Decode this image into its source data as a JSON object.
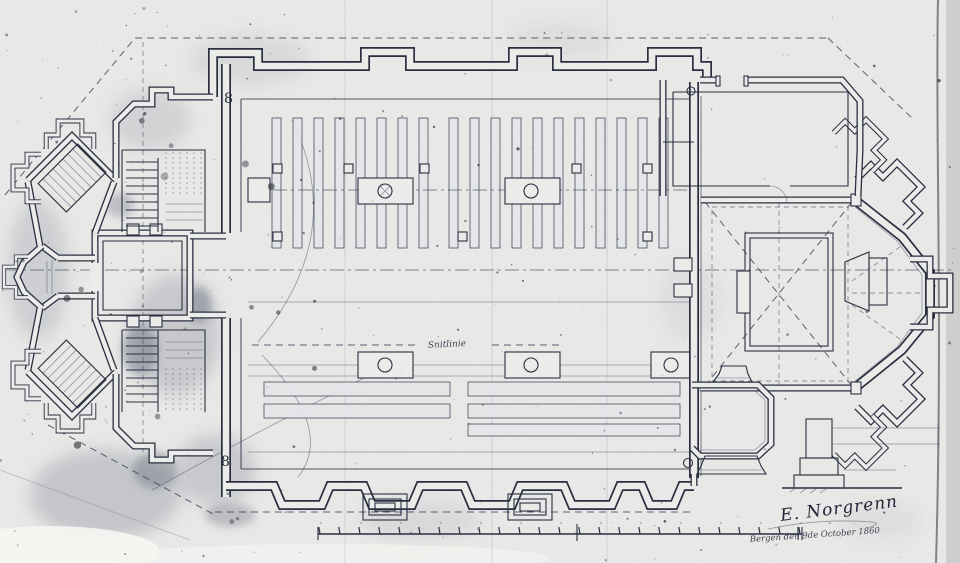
{
  "meta": {
    "title": "Scanned architectural ground plan of a church",
    "media": "photocopied ink drawing"
  },
  "colors": {
    "paper": "#ebebe9",
    "ink": "#2a2f40",
    "ink_faint": "#4a5068",
    "stain": "#7d8292"
  },
  "annotations": {
    "signature": "E. Norgrenn",
    "date_line": "Bergen den 9de October 1860",
    "center_line_label": "Snitlinie",
    "room_number_top": "8",
    "room_number_bottom": "8"
  },
  "scale_bar": {
    "tick_count": 25
  },
  "plan": {
    "parts": [
      "west-porch",
      "northwest-chapel",
      "southwest-chapel",
      "tower-hall",
      "north-staircase",
      "south-staircase",
      "nave",
      "pew-rows",
      "bench-rows",
      "chancel",
      "altar-platform",
      "altar",
      "apse",
      "apse-buttresses",
      "north-sacristy",
      "south-sacristy",
      "buttress-elevation-detail",
      "pier-plan-details",
      "scale-bar"
    ]
  }
}
